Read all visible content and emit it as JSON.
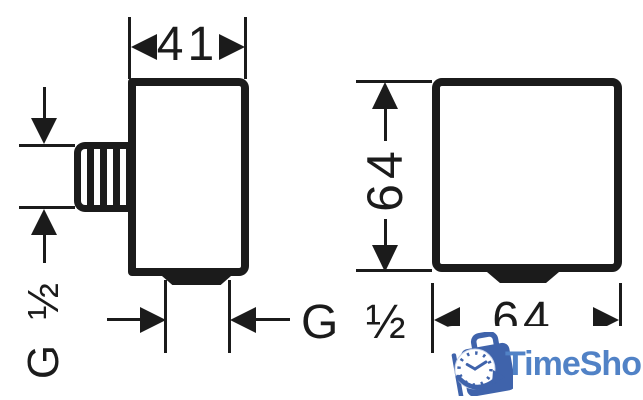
{
  "side_view": {
    "width_label": "41",
    "inlet_thread_label": "G ½",
    "outlet_thread_label": "G ½"
  },
  "front_view": {
    "height_label": "64",
    "width_label": "64"
  },
  "watermark": {
    "brand": "TimeShop"
  },
  "colors": {
    "line": "#1b1b1b",
    "logo_primary": "#3f63ab",
    "logo_text": "#5182c6",
    "background": "#ffffff"
  }
}
